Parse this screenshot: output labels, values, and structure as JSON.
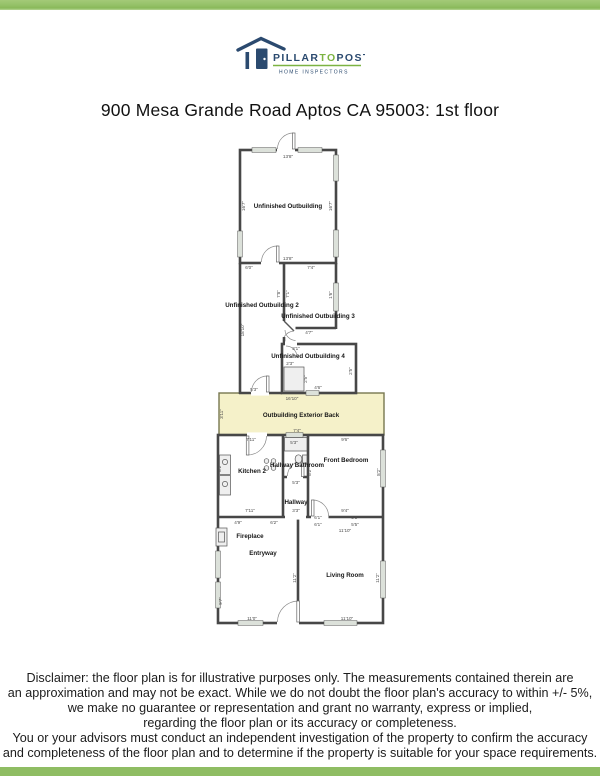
{
  "page": {
    "title": "900 Mesa Grande Road Aptos CA 95003: 1st floor"
  },
  "brand": {
    "part1": "PILLAR",
    "part2": "TO",
    "part3": "POST",
    "tagline": "HOME INSPECTORS",
    "navy": "#2b4a6f",
    "green": "#7cb342",
    "bar_green": "#8fbd63"
  },
  "colors": {
    "wall": "#474747",
    "exterior_highlight": "#f5f1c9",
    "window_fill": "#dce1da"
  },
  "floorplan": {
    "room_labels": [
      {
        "text": "Unfinished Outbuilding",
        "x": 288,
        "y": 208
      },
      {
        "text": "Unfinished Outbuilding 2",
        "x": 262,
        "y": 307
      },
      {
        "text": "Unfinished Outbuilding 3",
        "x": 318,
        "y": 318
      },
      {
        "text": "Unfinished Outbuilding 4",
        "x": 308,
        "y": 358
      },
      {
        "text": "Outbuilding Exterior Back",
        "x": 301,
        "y": 417
      },
      {
        "text": "Kitchen 2",
        "x": 252,
        "y": 473
      },
      {
        "text": "Hallway Bathroom",
        "x": 297,
        "y": 467
      },
      {
        "text": "Front Bedroom",
        "x": 346,
        "y": 462
      },
      {
        "text": "Hallway",
        "x": 296,
        "y": 504
      },
      {
        "text": "Fireplace",
        "x": 250,
        "y": 538
      },
      {
        "text": "Entryway",
        "x": 263,
        "y": 555
      },
      {
        "text": "Living Room",
        "x": 345,
        "y": 577
      }
    ],
    "dim_labels": [
      {
        "text": "13'8\"",
        "x": 288,
        "y": 158
      },
      {
        "text": "16'7\"",
        "x": 245,
        "y": 206,
        "rot": true
      },
      {
        "text": "16'7\"",
        "x": 332,
        "y": 206,
        "rot": true
      },
      {
        "text": "13'8\"",
        "x": 288,
        "y": 260
      },
      {
        "text": "6'0\"",
        "x": 249,
        "y": 269
      },
      {
        "text": "7'4\"",
        "x": 311,
        "y": 269
      },
      {
        "text": "7'8\"",
        "x": 280,
        "y": 294,
        "rot": true
      },
      {
        "text": "7'1\"",
        "x": 289,
        "y": 294,
        "rot": true
      },
      {
        "text": "1'6\"",
        "x": 332,
        "y": 295,
        "rot": true
      },
      {
        "text": "18'10\"",
        "x": 244,
        "y": 330,
        "rot": true
      },
      {
        "text": "4'7\"",
        "x": 309,
        "y": 334
      },
      {
        "text": "3'1\"",
        "x": 296,
        "y": 350
      },
      {
        "text": "2'3\"",
        "x": 290,
        "y": 365
      },
      {
        "text": "2'5\"",
        "x": 307,
        "y": 379,
        "rot": true
      },
      {
        "text": "2'5\"",
        "x": 352,
        "y": 371,
        "rot": true
      },
      {
        "text": "4'6\"",
        "x": 318,
        "y": 389
      },
      {
        "text": "5'3\"",
        "x": 254,
        "y": 391
      },
      {
        "text": "16'10\"",
        "x": 292,
        "y": 400
      },
      {
        "text": "3'11\"",
        "x": 223,
        "y": 414,
        "rot": true
      },
      {
        "text": "7'4\"",
        "x": 297,
        "y": 432
      },
      {
        "text": "7'11\"",
        "x": 251,
        "y": 441
      },
      {
        "text": "5'3\"",
        "x": 294,
        "y": 444
      },
      {
        "text": "9'6\"",
        "x": 345,
        "y": 441
      },
      {
        "text": "8'2\"",
        "x": 221,
        "y": 468,
        "rot": true
      },
      {
        "text": "8'2\"",
        "x": 311,
        "y": 472,
        "rot": true
      },
      {
        "text": "8'2\"",
        "x": 380,
        "y": 472,
        "rot": true
      },
      {
        "text": "5'3\"",
        "x": 296,
        "y": 484
      },
      {
        "text": "7'11\"",
        "x": 250,
        "y": 512
      },
      {
        "text": "3'3\"",
        "x": 296,
        "y": 512
      },
      {
        "text": "9'4\"",
        "x": 345,
        "y": 512
      },
      {
        "text": "4'9\"",
        "x": 238,
        "y": 524
      },
      {
        "text": "6'2\"",
        "x": 274,
        "y": 524
      },
      {
        "text": "6'1\"",
        "x": 318,
        "y": 519
      },
      {
        "text": "6'1\"",
        "x": 318,
        "y": 526
      },
      {
        "text": "5'5\"",
        "x": 355,
        "y": 519
      },
      {
        "text": "5'5\"",
        "x": 355,
        "y": 526
      },
      {
        "text": "11'10\"",
        "x": 345,
        "y": 532
      },
      {
        "text": "9'7\"",
        "x": 222,
        "y": 601,
        "rot": true
      },
      {
        "text": "11'2\"",
        "x": 296,
        "y": 578,
        "rot": true
      },
      {
        "text": "11'2\"",
        "x": 379,
        "y": 578,
        "rot": true
      },
      {
        "text": "11'0\"",
        "x": 252,
        "y": 620
      },
      {
        "text": "11'10\"",
        "x": 347,
        "y": 620
      }
    ]
  },
  "disclaimer": {
    "lines": [
      "Disclaimer: the floor plan is for illustrative purposes only. The measurements contained therein are",
      "an approximation and may not be exact. While we do not doubt the floor plan's accuracy to within +/- 5%,",
      "we make no guarantee or representation and grant no warranty, express or implied,",
      "regarding the floor plan or its accuracy or completeness.",
      "You or your advisors must conduct an independent investigation of the property to confirm the accuracy",
      "and completeness of the floor plan and to determine if the property is suitable for your space requirements."
    ]
  }
}
